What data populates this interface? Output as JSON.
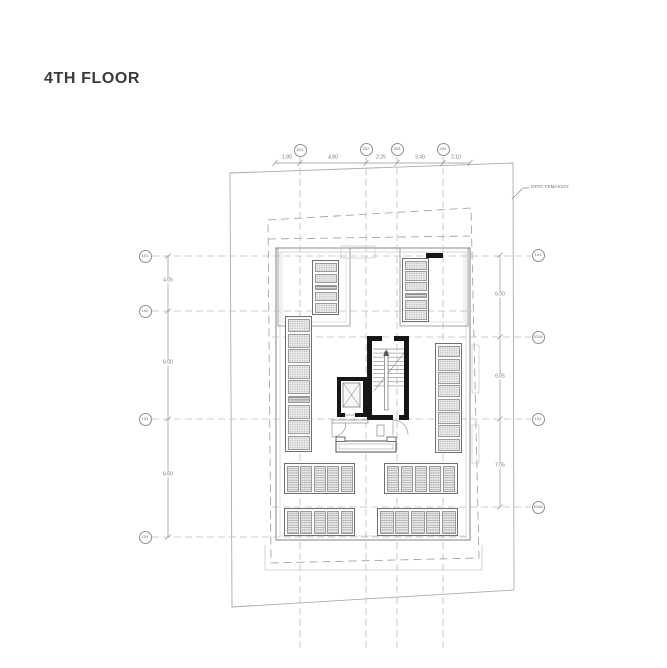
{
  "title": "4TH FLOOR",
  "annotations": {
    "boundary_note": "ΟΡΙΟ ΤΕΜΑΧΙΟΥ"
  },
  "grid_bubbles": {
    "top": [
      {
        "label": "201"
      },
      {
        "label": "202"
      },
      {
        "label": "203"
      },
      {
        "label": "204"
      }
    ],
    "left": [
      {
        "label": "101"
      },
      {
        "label": "102"
      },
      {
        "label": "103"
      },
      {
        "label": "104"
      }
    ],
    "right": [
      {
        "label": "101"
      },
      {
        "label": "102A"
      },
      {
        "label": "103"
      },
      {
        "label": "104A"
      }
    ]
  },
  "dimensions": {
    "top": [
      "1.80",
      "4.80",
      "2.25",
      "3.40",
      "2.10"
    ],
    "left": [
      "4.05",
      "8.00",
      "8.60"
    ],
    "right": [
      "6.00",
      "6.05",
      "7.05"
    ]
  },
  "colors": {
    "text": "#3a3a3a",
    "line_light": "#bcbcbc",
    "line_mid": "#8c8c8c",
    "wall_black": "#161616",
    "panel_fill": "#eaeaea"
  }
}
